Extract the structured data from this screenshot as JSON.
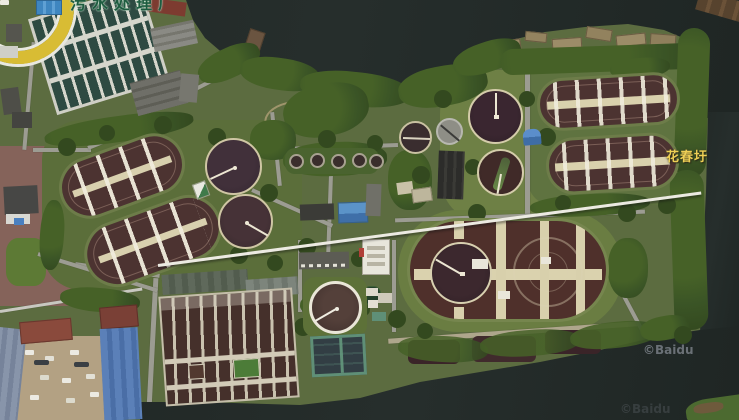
{
  "map": {
    "labels": {
      "plant_name_partial": "污水处理厂",
      "place_name": "花春圩"
    },
    "watermarks": {
      "primary": "©Baidu",
      "secondary": "©Baidu"
    },
    "colors": {
      "water": "#232a28",
      "vegetation_base": "#5c6c40",
      "tree_green": "#3b5526",
      "road_gray": "#9c9c92",
      "ditch_brown": "#4c3331",
      "clarifier_dark": "#362a2e",
      "walkway_tan": "#d8d0ac",
      "place_label_yellow": "#eecf55",
      "plant_label_green": "#1e5c40",
      "watermark_gray": "#7d838a"
    }
  }
}
